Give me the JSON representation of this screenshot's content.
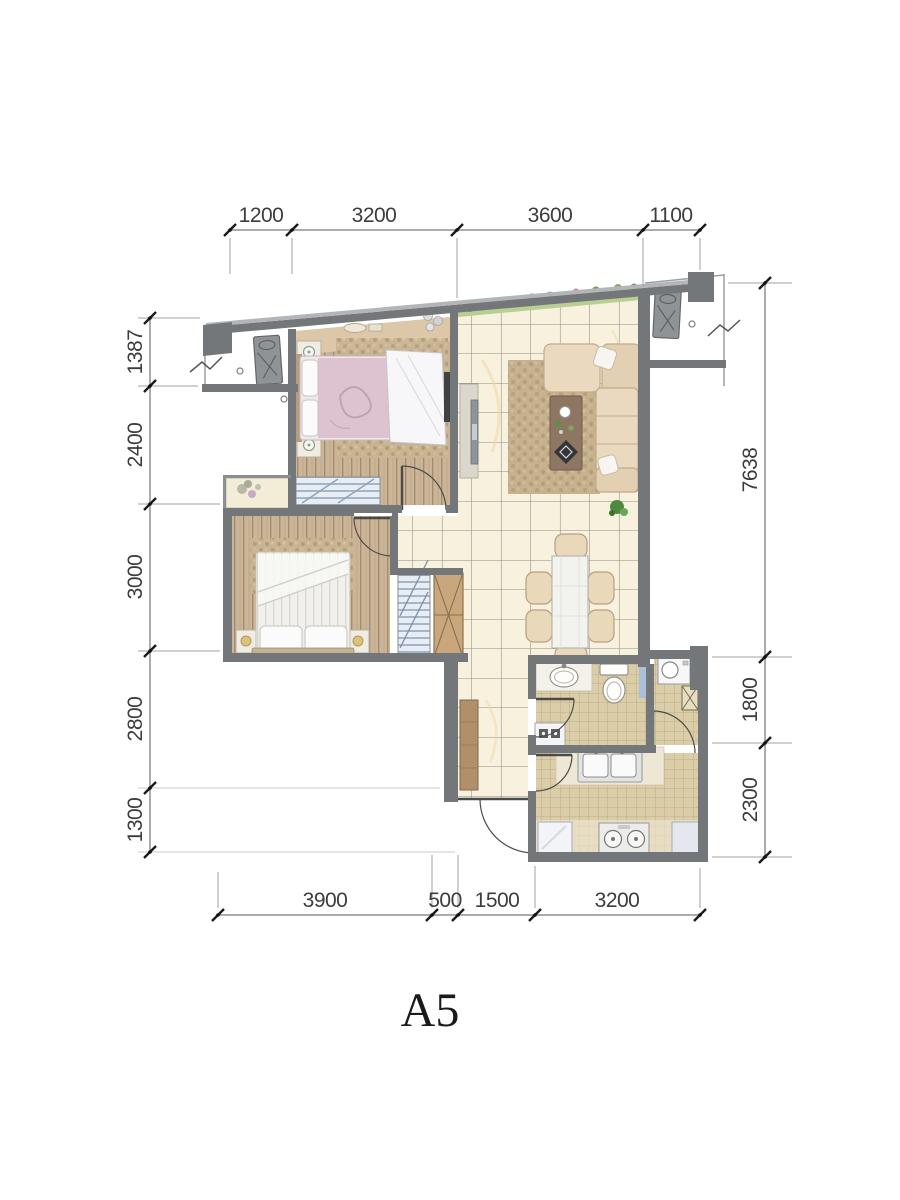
{
  "floorplan": {
    "unit_label": "A5",
    "dimensions": {
      "top": [
        "1200",
        "3200",
        "3600",
        "1100"
      ],
      "bottom": [
        "3900",
        "500",
        "1500",
        "3200"
      ],
      "left": [
        "1387",
        "2400",
        "3000",
        "2800",
        "1300"
      ],
      "right": [
        "7638",
        "1800",
        "2300"
      ]
    },
    "colors": {
      "wall": "#74777a",
      "wood_floor": "#cbb598",
      "tile_floor": "#f8f1dd",
      "kitchen_bath_tile": "#dbcda7",
      "planter_green": "#b9cf92",
      "sofa_beige": "#ead9bf",
      "wardrobe_stripe": "#a4b6ca",
      "dim_text": "#3c3c3c"
    }
  }
}
